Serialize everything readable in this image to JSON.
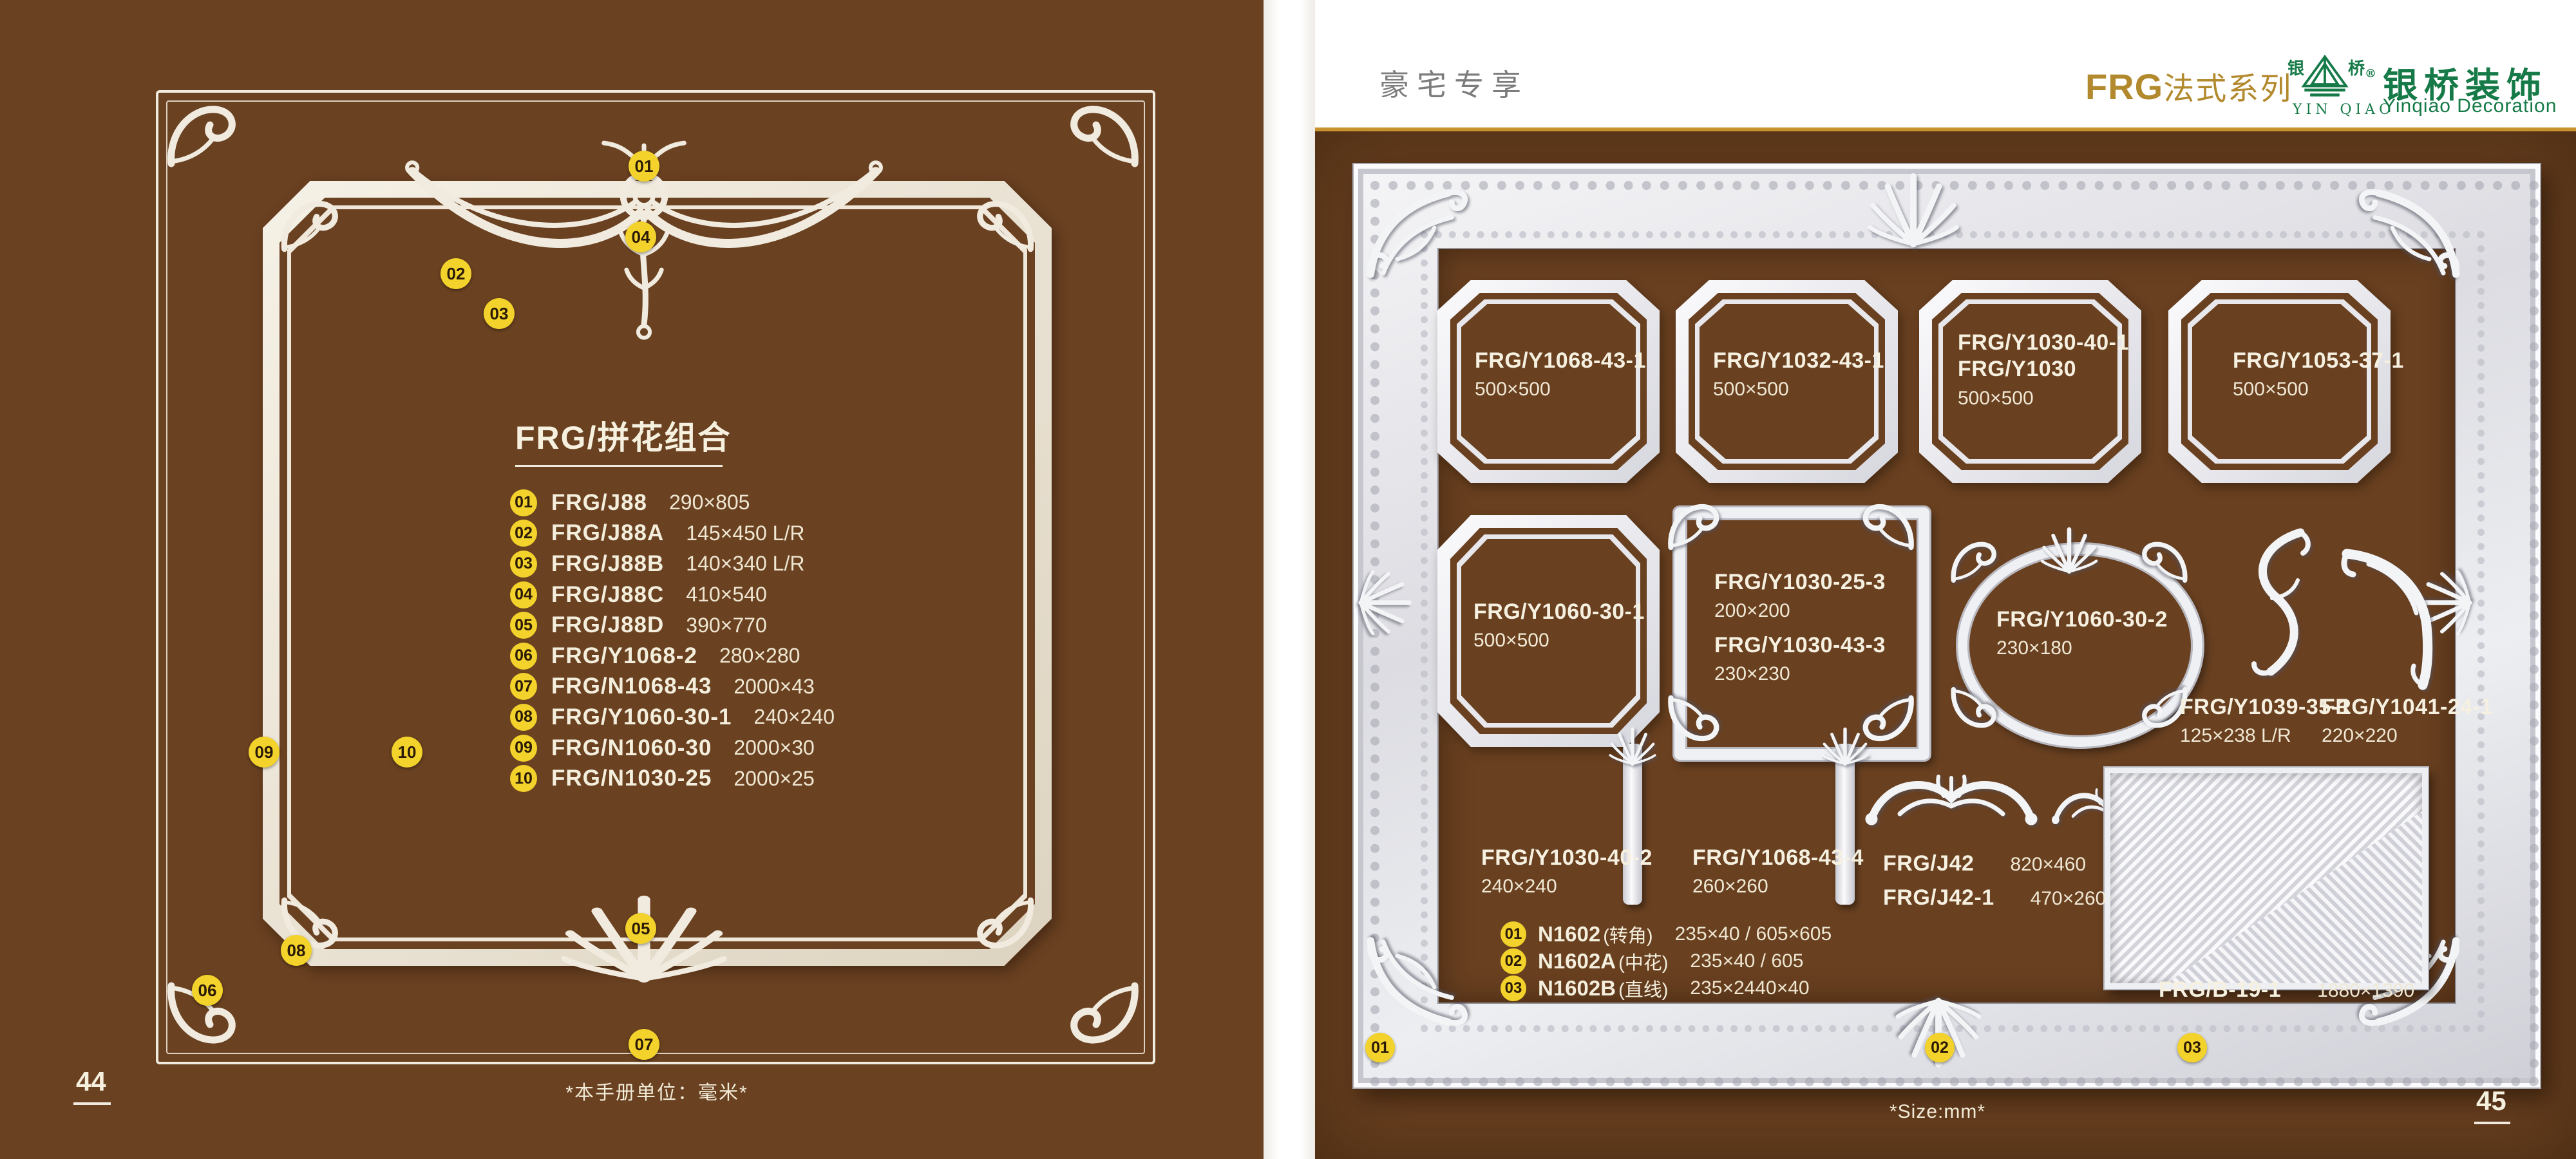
{
  "colors": {
    "page_brown": "#6a4121",
    "panel_brown": "#694020",
    "badge_yellow": "#f3d22b",
    "cream_text": "#f4eedd",
    "gold_accent": "#b2892d",
    "gold_rule": "#c8922e",
    "logo_green": "#157a47",
    "tagline_gray": "#7c7c7c"
  },
  "left_page": {
    "title_code": "FRG",
    "title_rest": "/拼花组合",
    "items": [
      {
        "num": "01",
        "code": "FRG/J88",
        "size": "290×805"
      },
      {
        "num": "02",
        "code": "FRG/J88A",
        "size": "145×450 L/R"
      },
      {
        "num": "03",
        "code": "FRG/J88B",
        "size": "140×340 L/R"
      },
      {
        "num": "04",
        "code": "FRG/J88C",
        "size": "410×540"
      },
      {
        "num": "05",
        "code": "FRG/J88D",
        "size": "390×770"
      },
      {
        "num": "06",
        "code": "FRG/Y1068-2",
        "size": "280×280"
      },
      {
        "num": "07",
        "code": "FRG/N1068-43",
        "size": "2000×43"
      },
      {
        "num": "08",
        "code": "FRG/Y1060-30-1",
        "size": "240×240"
      },
      {
        "num": "09",
        "code": "FRG/N1060-30",
        "size": "2000×30"
      },
      {
        "num": "10",
        "code": "FRG/N1030-25",
        "size": "2000×25"
      }
    ],
    "unit_note": "*本手册单位：毫米*",
    "page_no": "44"
  },
  "right_page": {
    "header": {
      "tagline": "豪宅专享",
      "series_latin": "FRG",
      "series_cn": "法式系列",
      "logo_char_left": "银",
      "logo_char_right": "桥",
      "logo_reg": "®",
      "logo_roman": "YIN QIAO",
      "logo_seal": "银桥装饰",
      "logo_en": "Yinqiao Decoration"
    },
    "products": {
      "p1": {
        "code": "FRG/Y1068-43-1",
        "size": "500×500"
      },
      "p2": {
        "code": "FRG/Y1032-43-1",
        "size": "500×500"
      },
      "p3": {
        "code": "FRG/Y1030-40-1",
        "code2": "FRG/Y1030",
        "size": "500×500"
      },
      "p4": {
        "code": "FRG/Y1053-37-1",
        "size": "500×500"
      },
      "p5": {
        "code": "FRG/Y1060-30-1",
        "size": "500×500"
      },
      "p6": {
        "code": "FRG/Y1030-25-3",
        "size": "200×200"
      },
      "p7": {
        "code": "FRG/Y1030-43-3",
        "size": "230×230"
      },
      "p8": {
        "code": "FRG/Y1060-30-2",
        "size": "230×180"
      },
      "p9": {
        "code": "FRG/Y1039-35-1",
        "size": "125×238 L/R"
      },
      "p10": {
        "code": "FRG/Y1041-24-1",
        "size": "220×220"
      },
      "p11": {
        "code": "FRG/Y1030-40-2",
        "size": "240×240"
      },
      "p12": {
        "code": "FRG/Y1068-43-4",
        "size": "260×260"
      },
      "p13": {
        "code": "FRG/J42",
        "size": "820×460"
      },
      "p14": {
        "code": "FRG/J42-1",
        "size": "470×260"
      },
      "p15": {
        "code": "FRG/B-19-1",
        "size": "1880×1390"
      }
    },
    "n_items": [
      {
        "num": "01",
        "code": "N1602",
        "paren": "(转角)",
        "size": "235×40 / 605×605"
      },
      {
        "num": "02",
        "code": "N1602A",
        "paren": "(中花)",
        "size": "235×40 / 605"
      },
      {
        "num": "03",
        "code": "N1602B",
        "paren": "(直线)",
        "size": "235×2440×40"
      }
    ],
    "size_note": "*Size:mm*",
    "page_no": "45"
  }
}
